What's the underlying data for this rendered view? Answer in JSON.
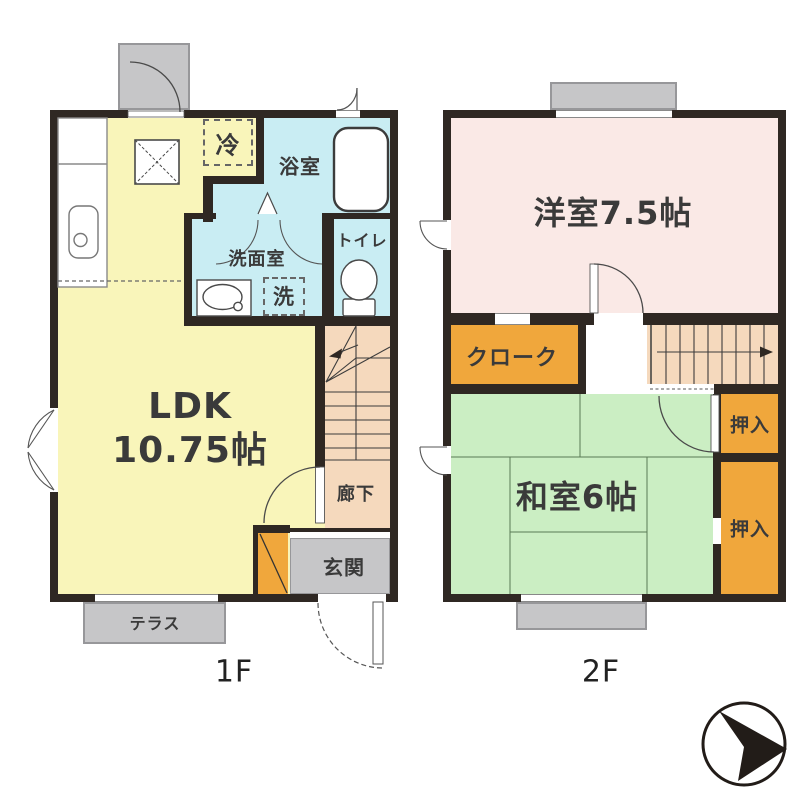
{
  "floor1": {
    "floor_label": "1F",
    "rooms": {
      "ldk_line1": "LDK",
      "ldk_line2": "10.75帖",
      "bathroom": "浴室",
      "washroom": "洗面室",
      "toilet": "トイレ",
      "washer": "洗",
      "fridge": "冷",
      "hallway": "廊下",
      "entrance": "玄関",
      "terrace": "テラス"
    }
  },
  "floor2": {
    "floor_label": "2F",
    "rooms": {
      "western_room": "洋室7.5帖",
      "cloak": "クローク",
      "japanese_room": "和室6帖",
      "closet_upper": "押入",
      "closet_lower": "押入"
    }
  },
  "colors": {
    "bg": "#ffffff",
    "wall": "#2f2823",
    "ldk": "#f9f5ba",
    "wet": "#c9edf3",
    "hall": "#f5d9bd",
    "storage": "#f0a73c",
    "western": "#fae9e6",
    "japanese": "#cbeec3",
    "outdoor": "#c6c6c8",
    "outdoor-border": "#97979a",
    "ink": "#3a3a3a"
  }
}
